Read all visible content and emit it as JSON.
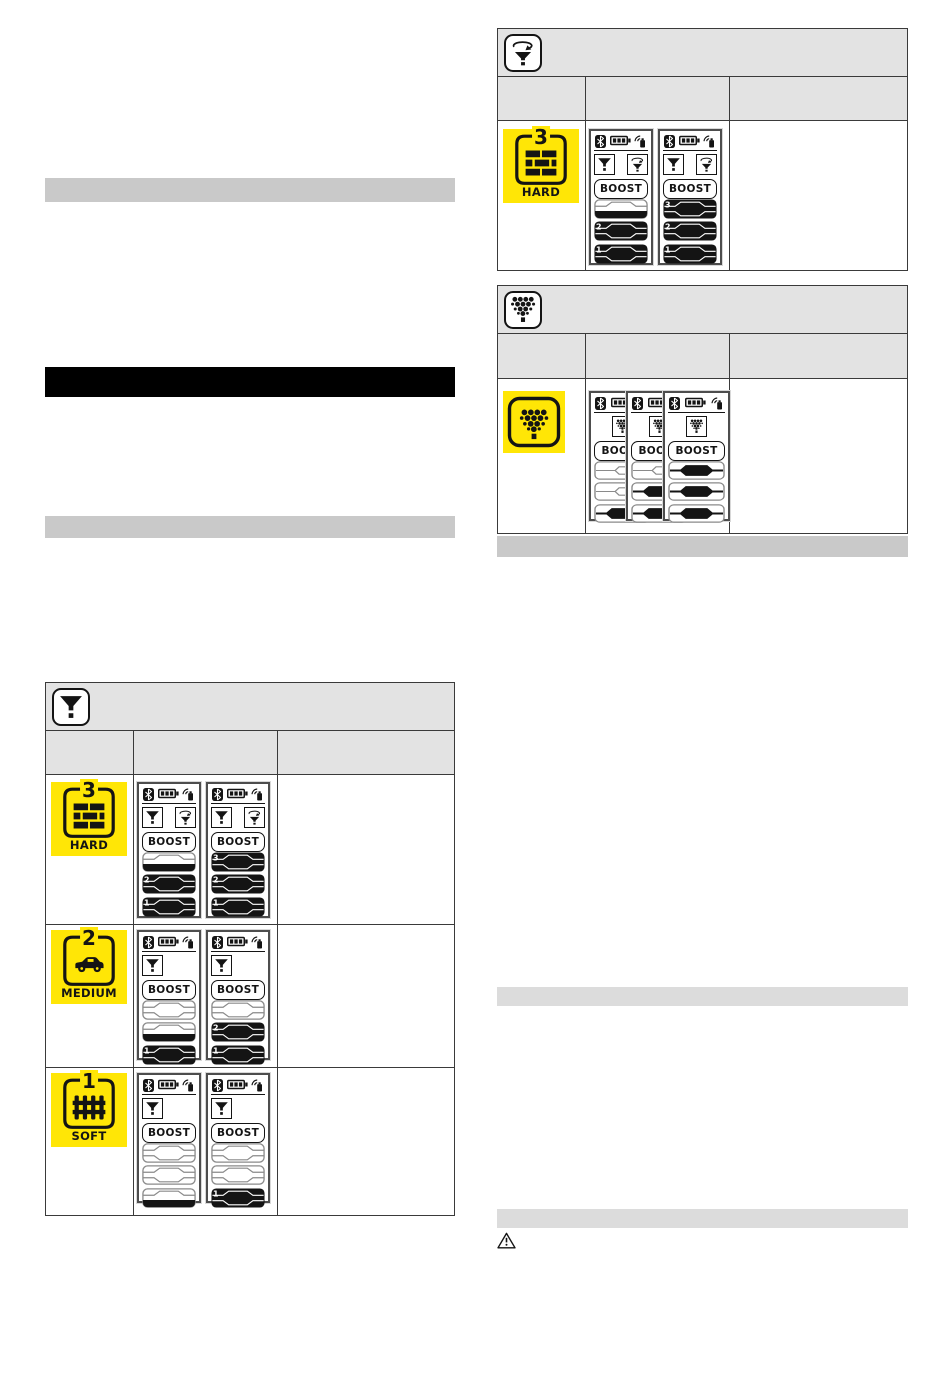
{
  "palette": {
    "yellow": "#ffe606",
    "ink": "#141414",
    "table_border": "#3a3a3a",
    "header_gray": "#e3e3e3",
    "bar_gray": "#c9c9c9",
    "bar_light_gray": "#dcdcdc",
    "black_banner": "#000000"
  },
  "labels": {
    "boost": "BOOST"
  },
  "redacted_bars": [
    {
      "name": "redacted-text-bar",
      "x": 45,
      "y": 178,
      "w": 410,
      "h": 24,
      "tone": "gray"
    },
    {
      "name": "section-heading-bar-black",
      "x": 45,
      "y": 367,
      "w": 410,
      "h": 30,
      "tone": "black"
    },
    {
      "name": "redacted-text-bar",
      "x": 45,
      "y": 516,
      "w": 410,
      "h": 22,
      "tone": "gray"
    },
    {
      "name": "redacted-text-bar",
      "x": 497,
      "y": 536,
      "w": 411,
      "h": 21,
      "tone": "gray"
    },
    {
      "name": "redacted-text-bar",
      "x": 497,
      "y": 987,
      "w": 411,
      "h": 19,
      "tone": "light"
    },
    {
      "name": "redacted-text-bar",
      "x": 497,
      "y": 1209,
      "w": 411,
      "h": 19,
      "tone": "light"
    }
  ],
  "warning_icon": {
    "x": 497,
    "y": 1232
  },
  "tables": [
    {
      "name": "funnel-mode-table",
      "x": 45,
      "y": 682,
      "w": 410,
      "header_icon": "funnel",
      "header_h": 48,
      "subheader_h": 44,
      "cols": [
        88,
        144
      ],
      "rows": [
        {
          "h": 150,
          "pad": 7,
          "screen_h": 136,
          "badge": {
            "number": "3",
            "glyph": "bricks",
            "label": "HARD",
            "w": 76
          },
          "screens": [
            {
              "funnels": [
                "funnel",
                "funnel-rotate"
              ],
              "gauges": [
                {
                  "state": "half"
                },
                {
                  "n": "2",
                  "state": "full"
                },
                {
                  "n": "1",
                  "state": "full"
                }
              ]
            },
            {
              "funnels": [
                "funnel",
                "funnel-rotate"
              ],
              "gauges": [
                {
                  "n": "3",
                  "state": "full"
                },
                {
                  "n": "2",
                  "state": "full"
                },
                {
                  "n": "1",
                  "state": "full"
                }
              ]
            }
          ]
        },
        {
          "h": 143,
          "pad": 5,
          "screen_h": 130,
          "badge": {
            "number": "2",
            "glyph": "car",
            "label": "MEDIUM",
            "w": 76
          },
          "screens": [
            {
              "funnels": [
                "funnel"
              ],
              "gauges": [
                {
                  "state": "empty"
                },
                {
                  "state": "half"
                },
                {
                  "n": "1",
                  "state": "full"
                }
              ]
            },
            {
              "funnels": [
                "funnel"
              ],
              "gauges": [
                {
                  "state": "empty"
                },
                {
                  "n": "2",
                  "state": "full"
                },
                {
                  "n": "1",
                  "state": "full"
                }
              ]
            }
          ]
        },
        {
          "h": 147,
          "pad": 5,
          "screen_h": 130,
          "badge": {
            "number": "1",
            "glyph": "fence",
            "label": "SOFT",
            "w": 76
          },
          "screens": [
            {
              "funnels": [
                "funnel"
              ],
              "gauges": [
                {
                  "state": "empty"
                },
                {
                  "state": "empty"
                },
                {
                  "state": "half"
                }
              ]
            },
            {
              "funnels": [
                "funnel"
              ],
              "gauges": [
                {
                  "state": "empty"
                },
                {
                  "state": "empty"
                },
                {
                  "n": "1",
                  "state": "full"
                }
              ]
            }
          ]
        }
      ]
    },
    {
      "name": "funnel-rotate-mode-table",
      "x": 497,
      "y": 28,
      "w": 411,
      "header_icon": "funnel-rotate",
      "header_h": 48,
      "subheader_h": 44,
      "cols": [
        88,
        144
      ],
      "rows": [
        {
          "h": 149,
          "pad": 8,
          "screen_h": 136,
          "badge": {
            "number": "3",
            "glyph": "bricks",
            "label": "HARD",
            "w": 76
          },
          "screens": [
            {
              "funnels": [
                "funnel",
                "funnel-rotate"
              ],
              "gauges": [
                {
                  "state": "half"
                },
                {
                  "n": "2",
                  "state": "full"
                },
                {
                  "n": "1",
                  "state": "full"
                }
              ]
            },
            {
              "funnels": [
                "funnel",
                "funnel-rotate"
              ],
              "gauges": [
                {
                  "n": "3",
                  "state": "full"
                },
                {
                  "n": "2",
                  "state": "full"
                },
                {
                  "n": "1",
                  "state": "full"
                }
              ]
            }
          ]
        }
      ]
    },
    {
      "name": "grapes-mode-table",
      "x": 497,
      "y": 285,
      "w": 411,
      "header_icon": "grapes",
      "header_h": 48,
      "subheader_h": 45,
      "cols": [
        88,
        144
      ],
      "rows": [
        {
          "h": 154,
          "pad": 12,
          "screen_h": 130,
          "overlap": true,
          "badge": {
            "glyph": "grapes",
            "w": 62
          },
          "screens": [
            {
              "funnels": [
                "grapes"
              ],
              "gauges": [
                {
                  "state": "line"
                },
                {
                  "state": "line"
                },
                {
                  "state": "blob"
                }
              ]
            },
            {
              "funnels": [
                "grapes"
              ],
              "gauges": [
                {
                  "state": "line"
                },
                {
                  "state": "blob"
                },
                {
                  "state": "blob"
                }
              ]
            },
            {
              "funnels": [
                "grapes"
              ],
              "gauges": [
                {
                  "state": "blob"
                },
                {
                  "state": "blob"
                },
                {
                  "state": "blob"
                }
              ]
            }
          ]
        }
      ]
    }
  ]
}
